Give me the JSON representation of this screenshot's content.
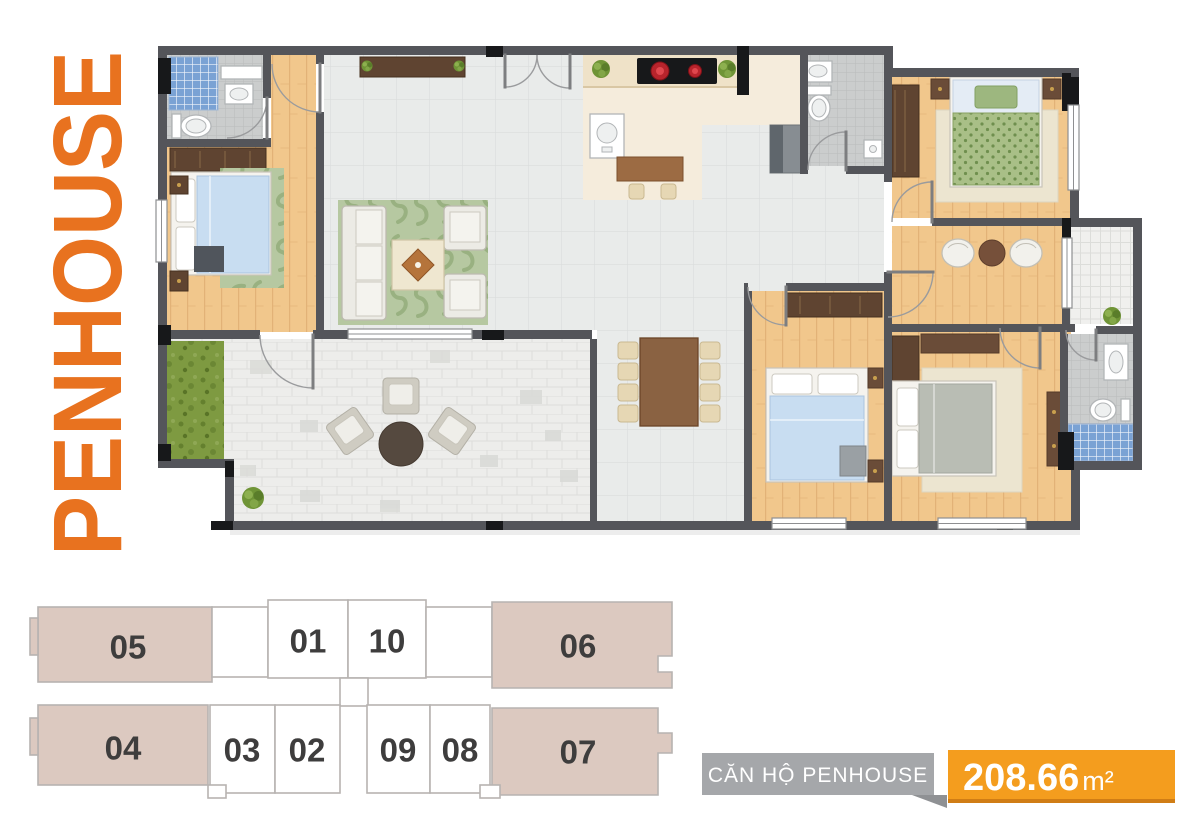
{
  "title": {
    "vertical_label": "PENHOUSE"
  },
  "caption": {
    "name_label": "CĂN HỘ PENHOUSE",
    "area_value": "208.66",
    "area_unit": "m²"
  },
  "keyplan": {
    "units": [
      {
        "id": "05",
        "label": "05",
        "highlighted": true
      },
      {
        "id": "01",
        "label": "01",
        "highlighted": false
      },
      {
        "id": "10",
        "label": "10",
        "highlighted": false
      },
      {
        "id": "06",
        "label": "06",
        "highlighted": true
      },
      {
        "id": "04",
        "label": "04",
        "highlighted": true
      },
      {
        "id": "03",
        "label": "03",
        "highlighted": false
      },
      {
        "id": "02",
        "label": "02",
        "highlighted": false
      },
      {
        "id": "09",
        "label": "09",
        "highlighted": false
      },
      {
        "id": "08",
        "label": "08",
        "highlighted": false
      },
      {
        "id": "07",
        "label": "07",
        "highlighted": true
      }
    ]
  },
  "colors": {
    "brand_orange": "#e8721f",
    "badge_orange": "#f49d1e",
    "badge_gray": "#a5a7aa",
    "keyplan_highlight": "#dcc9c0",
    "wall_gray": "#54555a"
  }
}
